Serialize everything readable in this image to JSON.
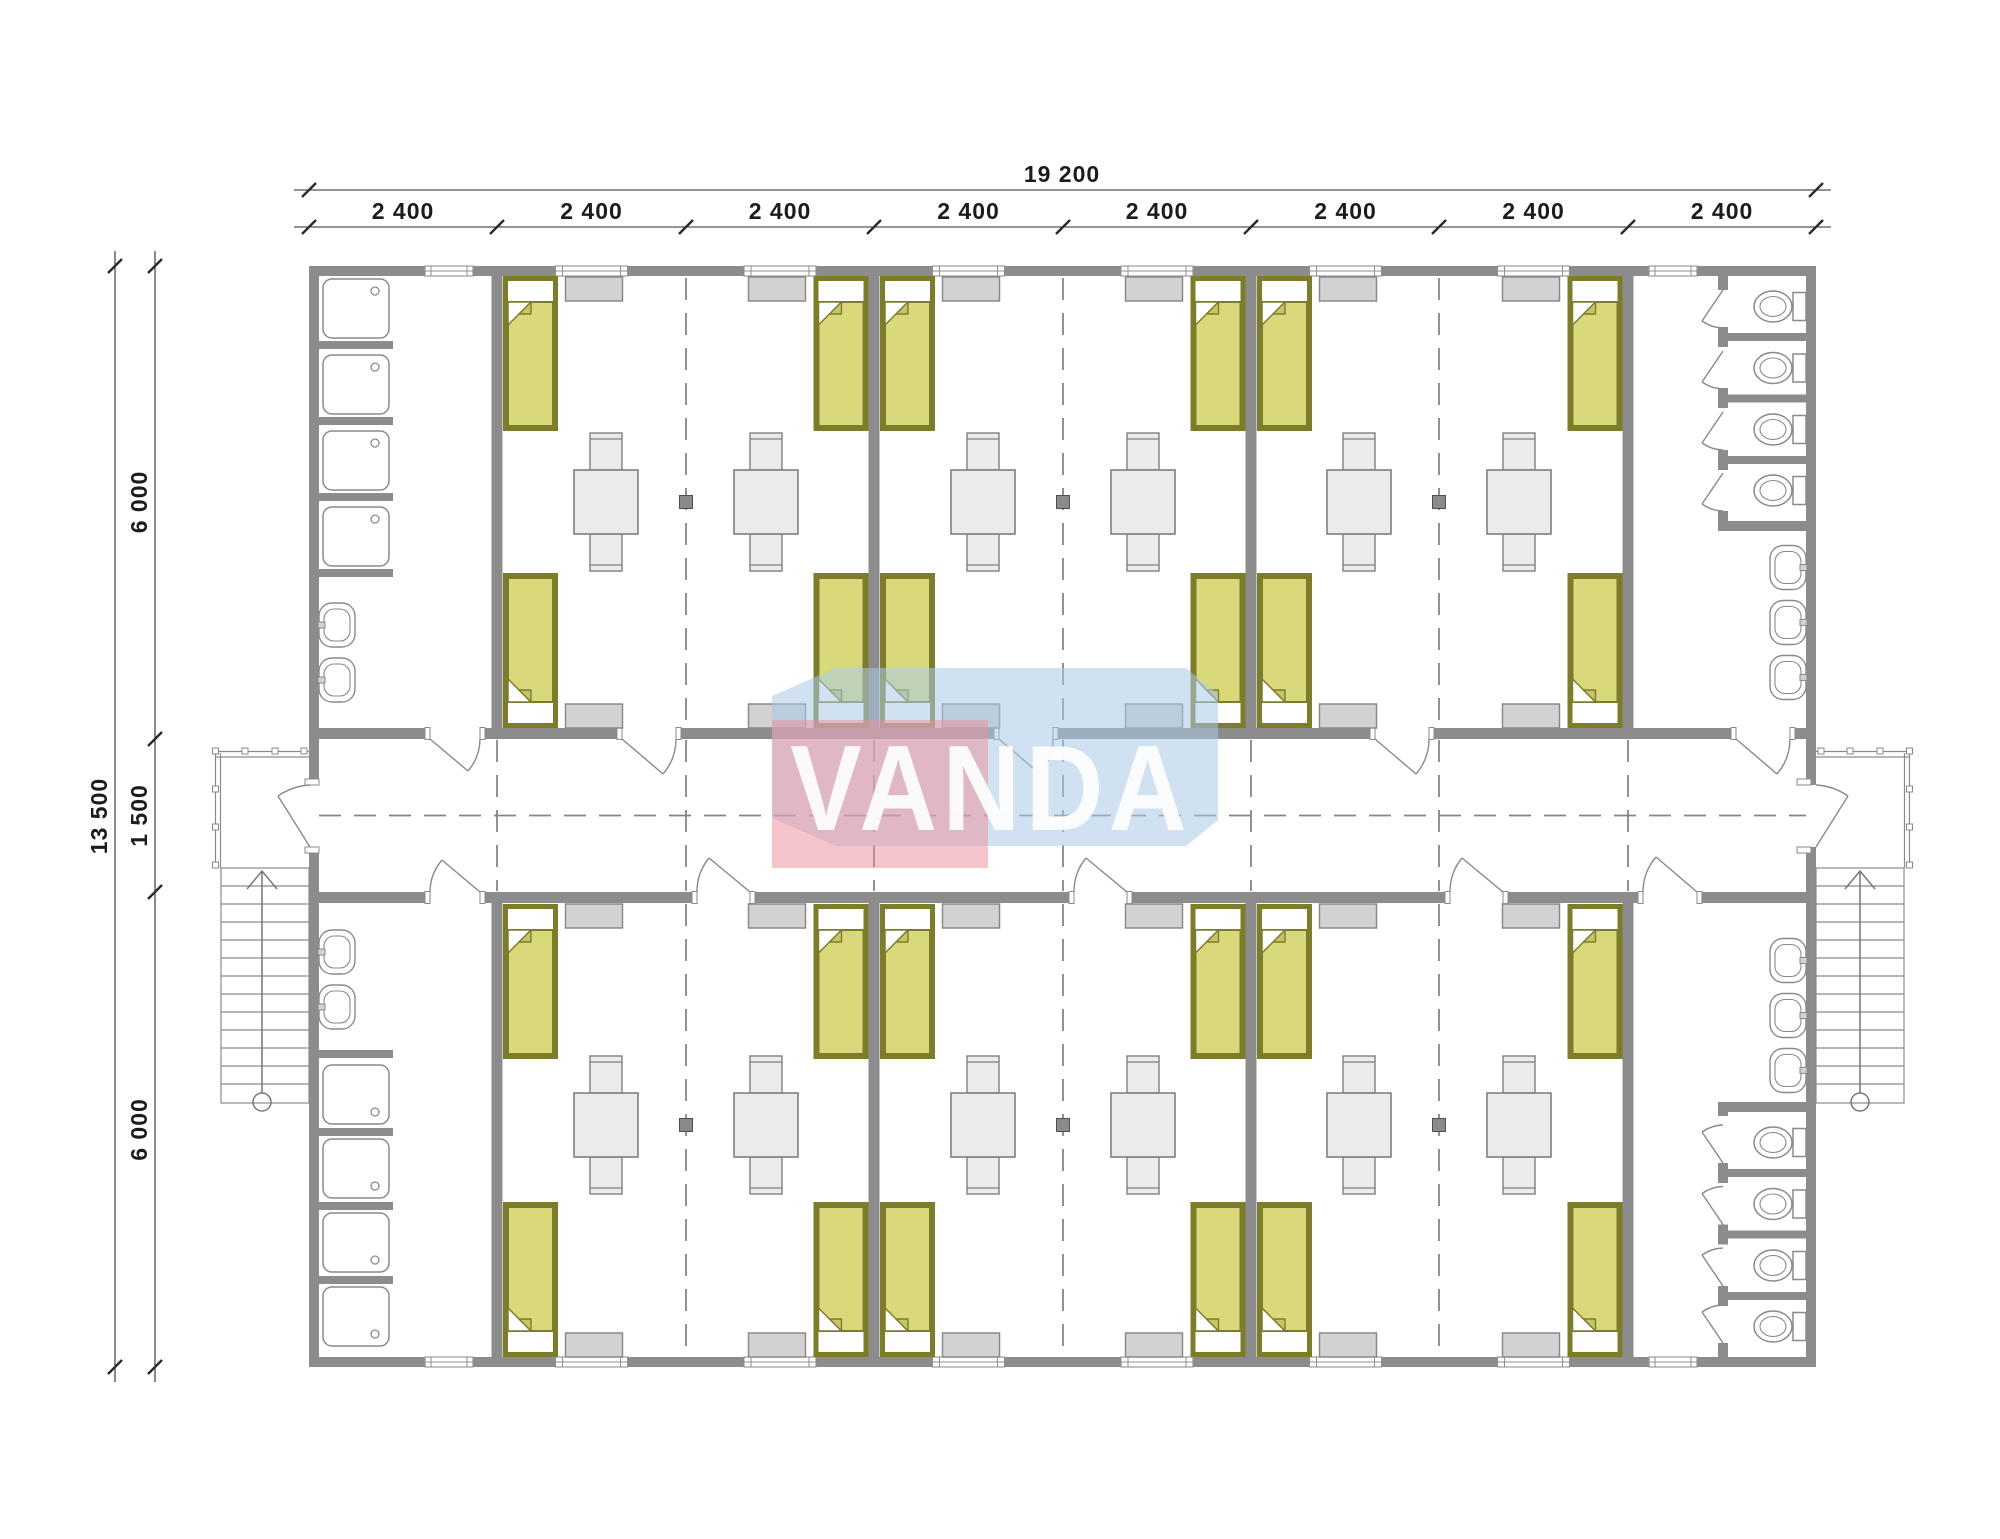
{
  "watermark": {
    "text": "VANDA"
  },
  "dimensions": {
    "top_total": "19 200",
    "top_segments": [
      "2 400",
      "2 400",
      "2 400",
      "2 400",
      "2 400",
      "2 400",
      "2 400",
      "2 400"
    ],
    "left_total": "13 500",
    "left_segments": [
      "6 000",
      "1 500",
      "6 000"
    ]
  },
  "palette": {
    "wall": "#8c8c8c",
    "bed_fill": "#d9d97c",
    "bed_frame": "#7c7c2b",
    "furniture_fill": "#ebebeb",
    "cabinet_fill": "#d2d2d2",
    "fixture_outline": "#8a8a8a",
    "dash_line": "#858585",
    "dimension_text": "#1c1c1c",
    "watermark_pink": "#ee8b99",
    "watermark_blue": "#a9cbe5",
    "watermark_text": "#ffffff"
  },
  "plan_summary": {
    "modules": 8,
    "bedrooms": 6,
    "beds": 24,
    "tables": 12,
    "chairs": 24,
    "wardrobes": 24,
    "showers": 8,
    "toilets": 8,
    "wash_basins": 10,
    "washrooms": 2,
    "wc_rooms": 2,
    "corridors": 1,
    "staircases": 2
  }
}
